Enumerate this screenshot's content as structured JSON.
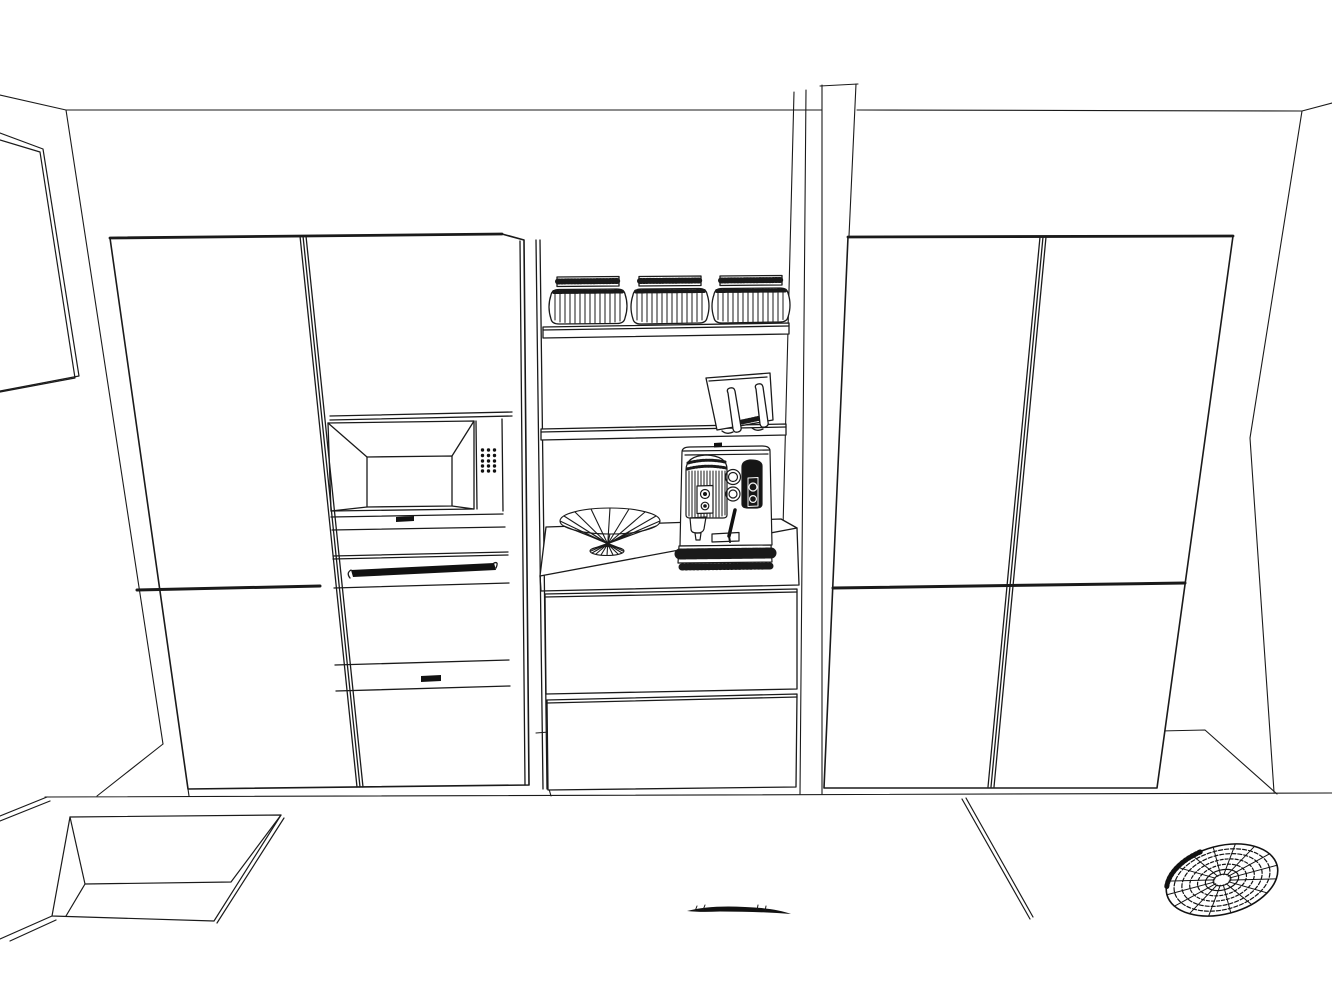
{
  "scene": {
    "view": "kitchen-3d-wireframe-elevation",
    "background": "#ffffff",
    "line_color": "#1a1a1a",
    "ink_color": "#111111",
    "objects": [
      {
        "id": "wall-art",
        "label": "wall picture frame"
      },
      {
        "id": "tall-cabinet-left",
        "label": "tall appliance cabinet, 2 columns"
      },
      {
        "id": "microwave",
        "label": "built-in microwave with dot control panel"
      },
      {
        "id": "oven",
        "label": "built-in oven with bar handle"
      },
      {
        "id": "open-shelf-top",
        "label": "floating shelf with jars"
      },
      {
        "id": "storage-jars",
        "label": "ribbed storage jars",
        "count": 3
      },
      {
        "id": "open-shelf-middle",
        "label": "floating shelf with cookbook stand"
      },
      {
        "id": "cookbook-stand",
        "label": "cookbook / tablet stand"
      },
      {
        "id": "wire-bowl",
        "label": "decorative wire fruit bowl"
      },
      {
        "id": "espresso-machine",
        "label": "espresso machine"
      },
      {
        "id": "drawer-unit",
        "label": "counter with two drawers",
        "drawer_count": 2
      },
      {
        "id": "tall-cabinet-right",
        "label": "tall cabinet, four doors"
      },
      {
        "id": "sink",
        "label": "undermount sink in left counter"
      },
      {
        "id": "vent-grille",
        "label": "round cooktop vent grille"
      },
      {
        "id": "floor-sliver",
        "label": "thin object on floor"
      }
    ]
  }
}
